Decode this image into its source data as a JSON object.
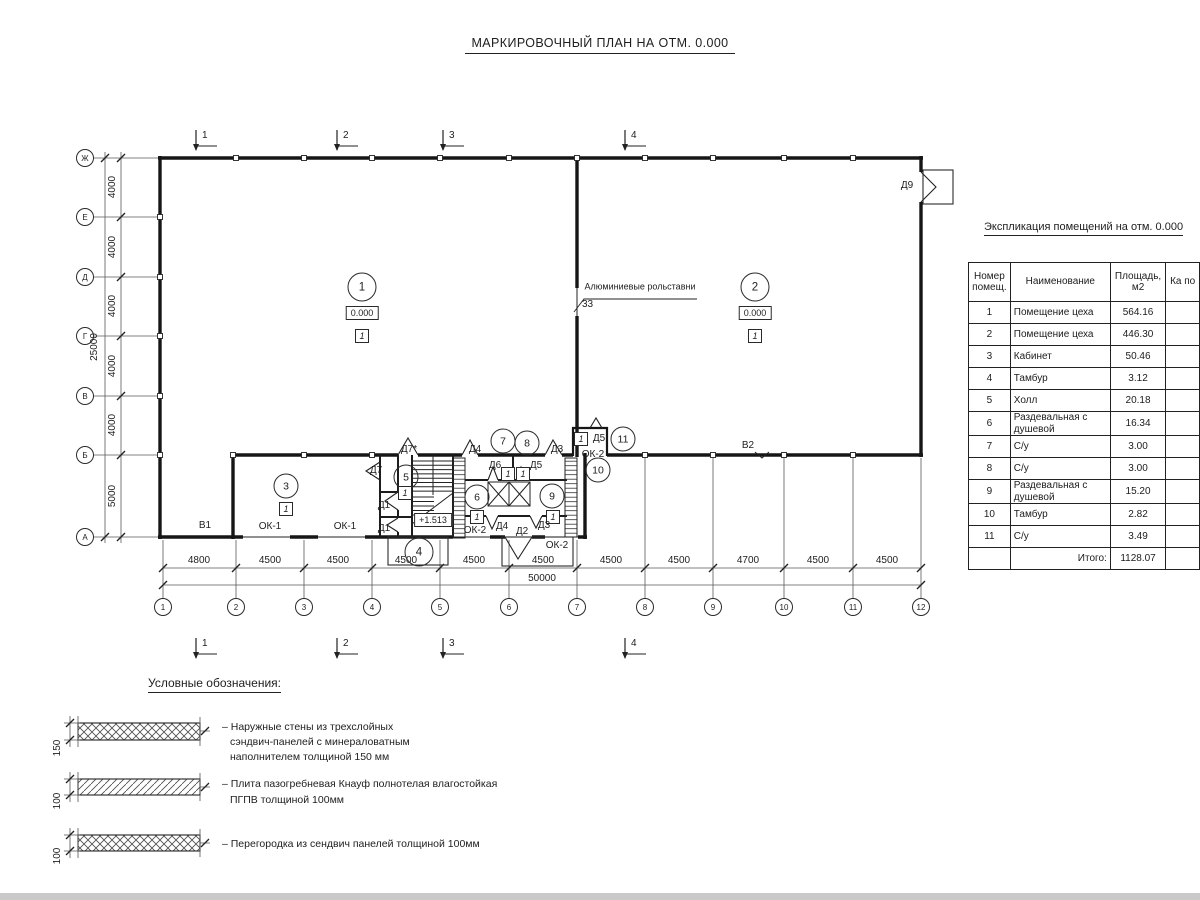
{
  "title": "МАРКИРОВОЧНЫЙ ПЛАН НА ОТМ. 0.000",
  "plan": {
    "section_marks": [
      "1",
      "2",
      "3",
      "4"
    ],
    "axes_left": [
      "Ж",
      "Е",
      "Д",
      "Г",
      "В",
      "Б",
      "А"
    ],
    "axes_bottom": [
      "1",
      "2",
      "3",
      "4",
      "5",
      "6",
      "7",
      "8",
      "9",
      "10",
      "11",
      "12"
    ],
    "dims_bottom": [
      "4800",
      "4500",
      "4500",
      "4500",
      "4500",
      "4500",
      "4500",
      "4500",
      "4700",
      "4500",
      "4500"
    ],
    "dim_total_bottom": "50000",
    "dims_left": [
      "4000",
      "4000",
      "4000",
      "4000",
      "4000",
      "5000"
    ],
    "dim_total_left": "25000",
    "rooms": [
      "1",
      "2",
      "3",
      "4",
      "5",
      "6",
      "7",
      "8",
      "9",
      "10",
      "11"
    ],
    "level_zero": "0.000",
    "level_stair": "+1.513",
    "type_mark": "1",
    "labels": {
      "d1": "Д1",
      "d2": "Д2",
      "d3": "Д3",
      "d4": "Д4",
      "d5": "Д5",
      "d6": "Д6",
      "d7": "Д7",
      "d7s": "Д7*",
      "d9": "Д9",
      "ok1": "ОК-1",
      "ok2": "ОК-2",
      "v1": "В1",
      "v2": "В2"
    },
    "annotation": {
      "text": "Алюминиевые рольставни",
      "mark": "33"
    }
  },
  "schedule": {
    "title": "Экспликация помещений на отм. 0.000",
    "columns": {
      "number": "Номер помещ.",
      "name": "Наименование",
      "area": "Площадь, м2",
      "category": "Ка по"
    },
    "rows": [
      {
        "n": "1",
        "name": "Помещение цеха",
        "area": "564.16"
      },
      {
        "n": "2",
        "name": "Помещение цеха",
        "area": "446.30"
      },
      {
        "n": "3",
        "name": "Кабинет",
        "area": "50.46"
      },
      {
        "n": "4",
        "name": "Тамбур",
        "area": "3.12"
      },
      {
        "n": "5",
        "name": "Холл",
        "area": "20.18"
      },
      {
        "n": "6",
        "name": "Раздевальная с душевой",
        "area": "16.34"
      },
      {
        "n": "7",
        "name": "С/у",
        "area": "3.00"
      },
      {
        "n": "8",
        "name": "С/у",
        "area": "3.00"
      },
      {
        "n": "9",
        "name": "Раздевальная с душевой",
        "area": "15.20"
      },
      {
        "n": "10",
        "name": "Тамбур",
        "area": "2.82"
      },
      {
        "n": "11",
        "name": "С/у",
        "area": "3.49"
      }
    ],
    "total_label": "Итого:",
    "total_value": "1128.07"
  },
  "legend": {
    "title": "Условные обозначения:",
    "items": [
      {
        "thickness": "150",
        "lines": [
          "– Наружные стены из трехслойных",
          "сэндвич-панелей с минераловатным",
          "наполнителем толщиной 150 мм"
        ]
      },
      {
        "thickness": "100",
        "lines": [
          "– Плита пазогребневая Кнауф полнотелая влагостойкая",
          "ПГПВ толщиной 100мм"
        ]
      },
      {
        "thickness": "100",
        "lines": [
          "– Перегородка из сендвич панелей толщиной 100мм"
        ]
      }
    ]
  }
}
